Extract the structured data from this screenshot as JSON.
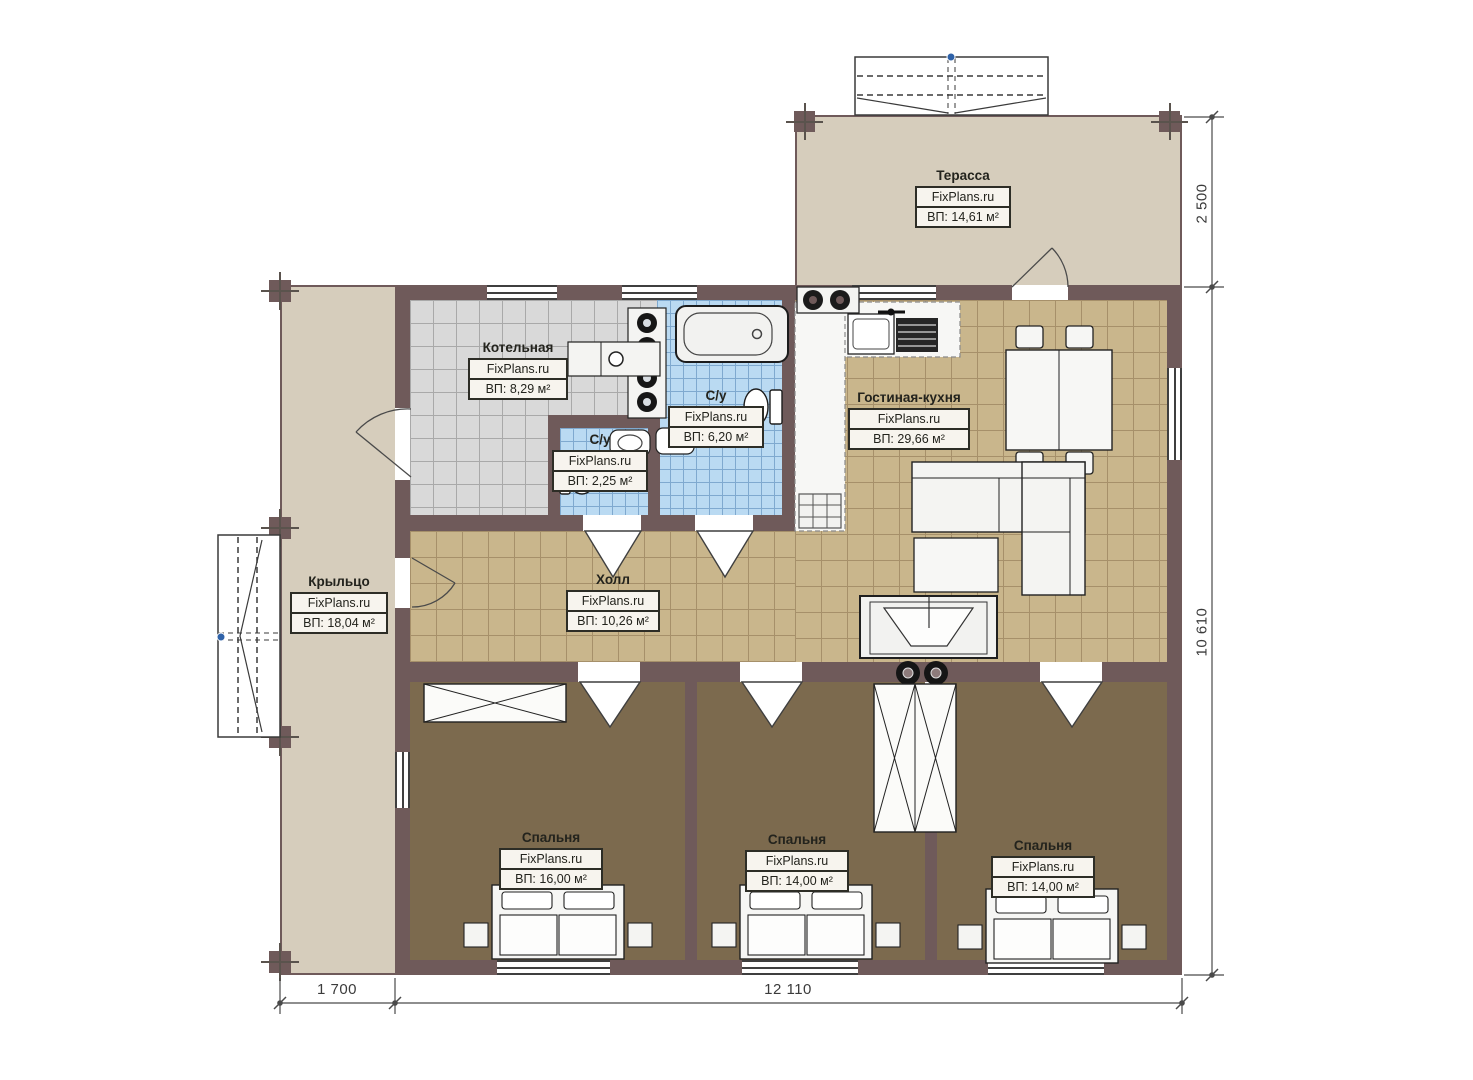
{
  "plan": {
    "rooms": [
      {
        "id": "terrace",
        "name": "Терасса",
        "brand": "FixPlans.ru",
        "area": "ВП: 14,61 м²"
      },
      {
        "id": "boiler",
        "name": "Котельная",
        "brand": "FixPlans.ru",
        "area": "ВП: 8,29 м²"
      },
      {
        "id": "bath-large",
        "name": "С/у",
        "brand": "FixPlans.ru",
        "area": "ВП: 6,20 м²"
      },
      {
        "id": "bath-small",
        "name": "С/у",
        "brand": "FixPlans.ru",
        "area": "ВП: 2,25 м²"
      },
      {
        "id": "living-kitchen",
        "name": "Гостиная-кухня",
        "brand": "FixPlans.ru",
        "area": "ВП: 29,66 м²"
      },
      {
        "id": "porch",
        "name": "Крыльцо",
        "brand": "FixPlans.ru",
        "area": "ВП: 18,04 м²"
      },
      {
        "id": "hall",
        "name": "Холл",
        "brand": "FixPlans.ru",
        "area": "ВП: 10,26 м²"
      },
      {
        "id": "bedroom-1",
        "name": "Спальня",
        "brand": "FixPlans.ru",
        "area": "ВП: 16,00 м²"
      },
      {
        "id": "bedroom-2",
        "name": "Спальня",
        "brand": "FixPlans.ru",
        "area": "ВП: 14,00 м²"
      },
      {
        "id": "bedroom-3",
        "name": "Спальня",
        "brand": "FixPlans.ru",
        "area": "ВП: 14,00 м²"
      }
    ],
    "dimensions": {
      "right_top": "2 500",
      "right_main": "10 610",
      "bottom_left": "1 700",
      "bottom_main": "12 110"
    },
    "colors": {
      "beige": "#d6cdbc",
      "wall": "#6f5a5a",
      "tile_tan": "#c9b68c",
      "tile_gray": "#d9d9d9",
      "tile_blue": "#badaf2",
      "bedroom_floor": "#7c6a4e"
    }
  }
}
